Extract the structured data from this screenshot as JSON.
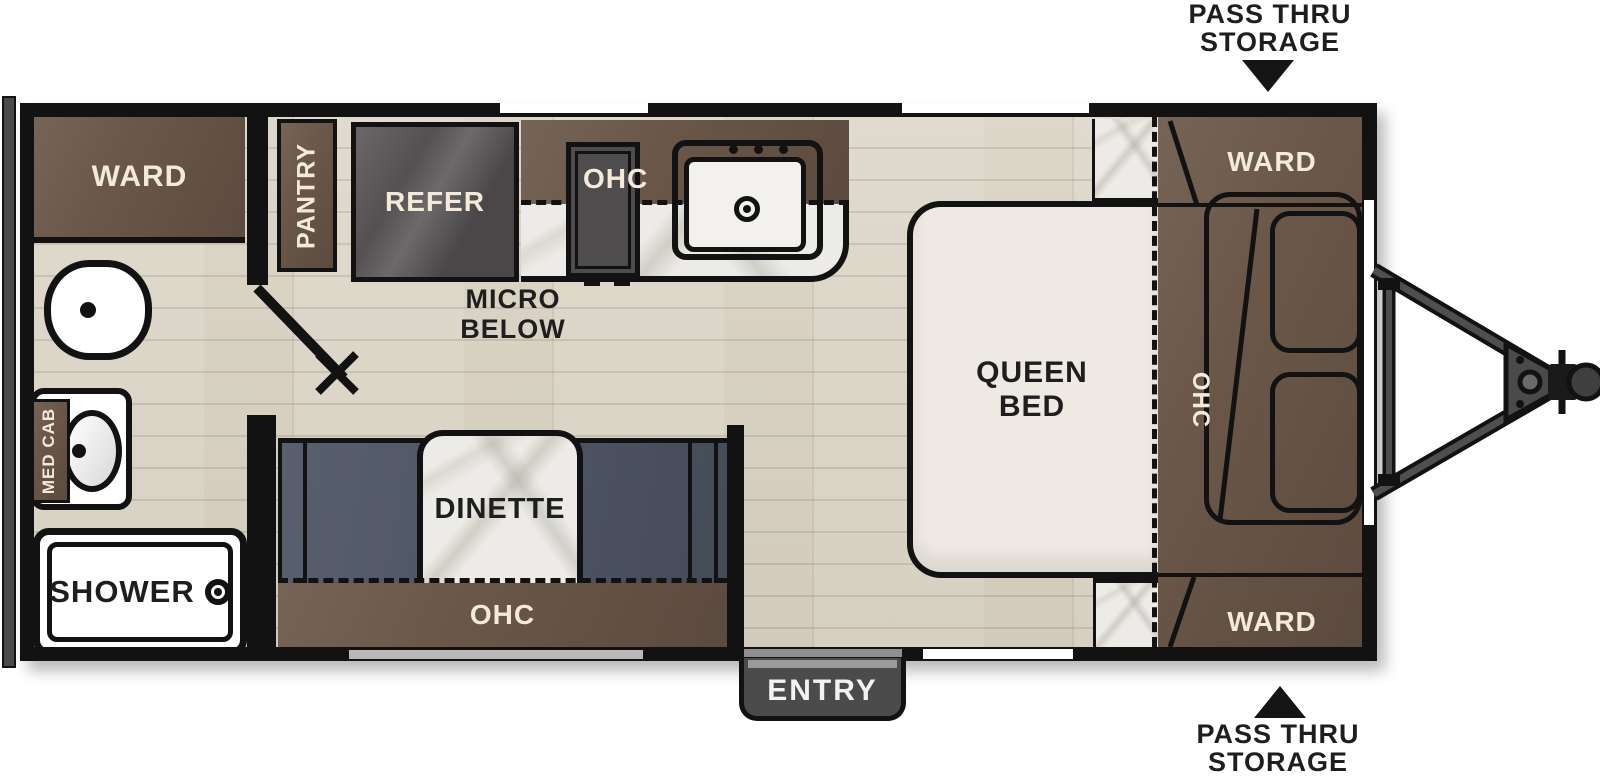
{
  "floorplan": {
    "type": "travel-trailer-floorplan",
    "annotations": {
      "pass_thru_top": {
        "line1": "PASS THRU",
        "line2": "STORAGE"
      },
      "pass_thru_bottom": {
        "line1": "PASS THRU",
        "line2": "STORAGE"
      }
    },
    "rooms": {
      "ward_rear": "WARD",
      "pantry": "PANTRY",
      "refer": "REFER",
      "kitchen_ohc": "OHC",
      "micro": {
        "line1": "MICRO",
        "line2": "BELOW"
      },
      "dinette": "DINETTE",
      "dinette_ohc": "OHC",
      "queen_bed": {
        "line1": "QUEEN",
        "line2": "BED"
      },
      "bed_ohc": "OHC",
      "ward_front_top": "WARD",
      "ward_front_bottom": "WARD",
      "med_cab": "MED CAB",
      "shower": "SHOWER",
      "entry": "ENTRY"
    },
    "colors": {
      "cabinet_brown": "#6a5748",
      "bench_slate": "#4e5565",
      "appliance_gray": "#555153",
      "wall_black": "#121212",
      "floor_wood": "#d9d3c5",
      "marble": "#edebe7",
      "bed_cream": "#eee9e2",
      "label_cream": "#f3ead9",
      "entry_step_gray": "#4b4b4b"
    }
  }
}
